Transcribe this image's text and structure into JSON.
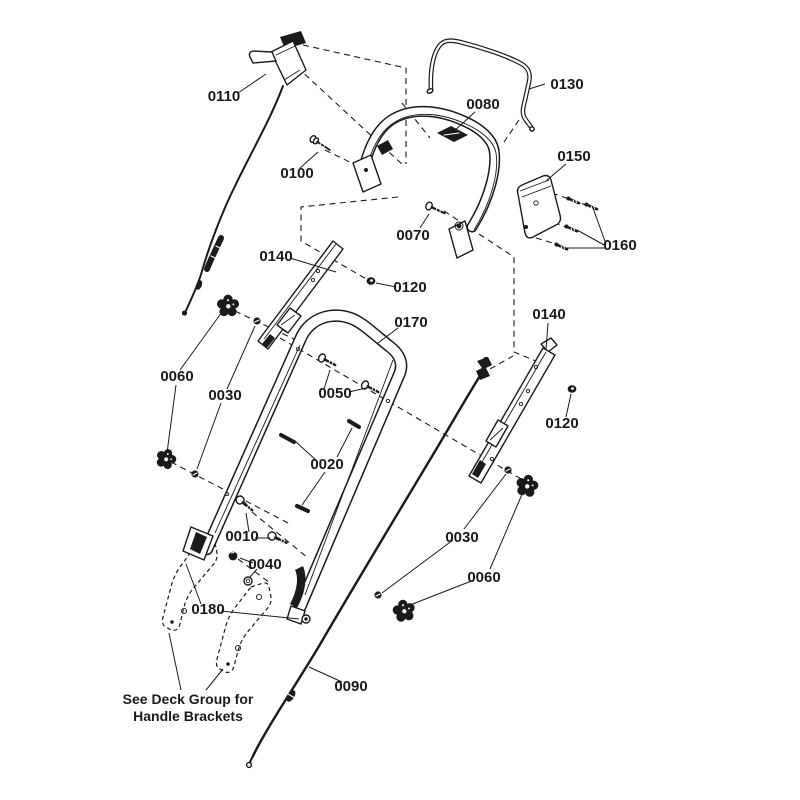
{
  "diagram": {
    "kind": "exploded-parts-diagram",
    "subject": "handle-assembly",
    "colors": {
      "line": "#1a1a1a",
      "background": "#ffffff"
    },
    "note": {
      "line1": "See Deck Group for",
      "line2": "Handle Brackets"
    },
    "callouts": [
      {
        "ref": "callout-0110",
        "text": "0110"
      },
      {
        "ref": "callout-0100",
        "text": "0100"
      },
      {
        "ref": "callout-0130",
        "text": "0130"
      },
      {
        "ref": "callout-0080",
        "text": "0080"
      },
      {
        "ref": "callout-0150",
        "text": "0150"
      },
      {
        "ref": "callout-0160",
        "text": "0160"
      },
      {
        "ref": "callout-0070",
        "text": "0070"
      },
      {
        "ref": "callout-0140-left",
        "text": "0140"
      },
      {
        "ref": "callout-0120-left",
        "text": "0120"
      },
      {
        "ref": "callout-0170",
        "text": "0170"
      },
      {
        "ref": "callout-0140-right",
        "text": "0140"
      },
      {
        "ref": "callout-0120-right",
        "text": "0120"
      },
      {
        "ref": "callout-0050",
        "text": "0050"
      },
      {
        "ref": "callout-0060-left",
        "text": "0060"
      },
      {
        "ref": "callout-0030-left",
        "text": "0030"
      },
      {
        "ref": "callout-0020",
        "text": "0020"
      },
      {
        "ref": "callout-0010",
        "text": "0010"
      },
      {
        "ref": "callout-0040",
        "text": "0040"
      },
      {
        "ref": "callout-0180",
        "text": "0180"
      },
      {
        "ref": "callout-0030-right",
        "text": "0030"
      },
      {
        "ref": "callout-0060-right",
        "text": "0060"
      },
      {
        "ref": "callout-0090",
        "text": "0090"
      }
    ]
  }
}
